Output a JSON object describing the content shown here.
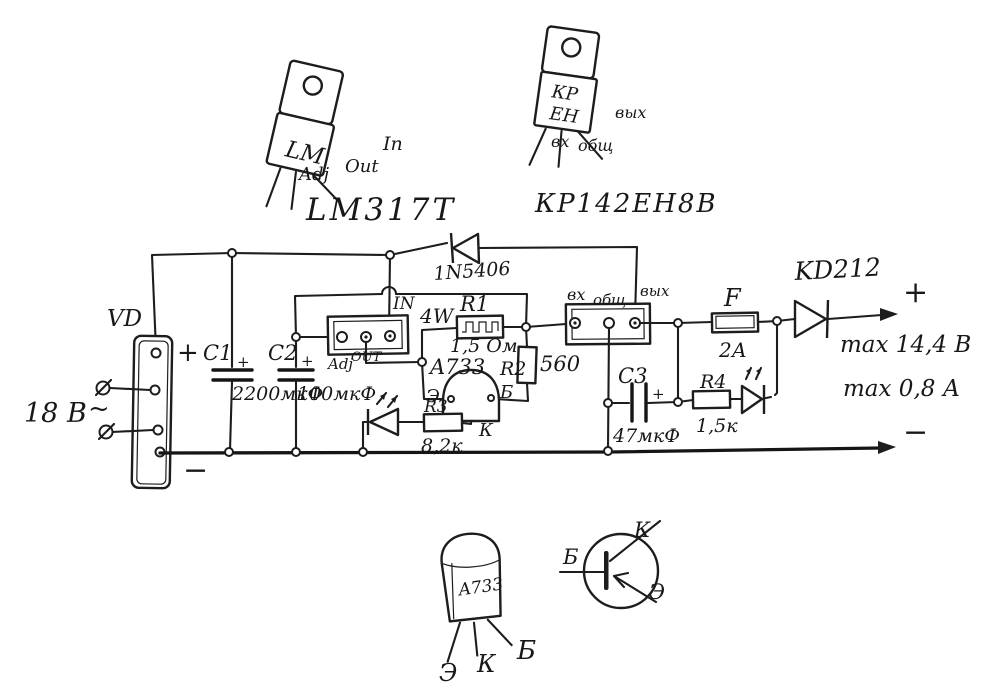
{
  "page": {
    "background": "#ffffff",
    "ink": "#1b1b1b"
  },
  "packages": {
    "lm317": {
      "title": "LM317T",
      "body": "LM",
      "pin_adj": "Adj",
      "pin_out": "Out",
      "pin_in": "In"
    },
    "kren": {
      "title": "КР142ЕН8В",
      "body_top": "КР",
      "body_bottom": "ЕН",
      "pin_in": "вх",
      "pin_gnd": "общ",
      "pin_out": "вых"
    }
  },
  "schematic": {
    "bridge": {
      "label": "VD",
      "plus": "+",
      "minus": "−",
      "input_voltage": "18 В",
      "ac_symbol": "~"
    },
    "protection_diode": {
      "label": "1N5406"
    },
    "regulator1": {
      "pin_in": "IN",
      "pin_adj": "Adj",
      "pin_out": "OUT"
    },
    "r1": {
      "label": "R1",
      "power": "4W",
      "value": "1,5 Ом"
    },
    "r2": {
      "label": "R2",
      "value": "560"
    },
    "r3": {
      "label": "R3",
      "value": "8,2к"
    },
    "r4": {
      "label": "R4",
      "value": "1,5к"
    },
    "c1": {
      "label": "C1",
      "value": "2200мкФ",
      "polarity": "+"
    },
    "c2": {
      "label": "C2",
      "value": "100мкФ",
      "polarity": "+"
    },
    "c3": {
      "label": "C3",
      "value": "47мкФ",
      "polarity": "+"
    },
    "q1": {
      "label": "A733",
      "emitter": "Э",
      "base": "Б",
      "collector": "К"
    },
    "regulator2": {
      "pin_in": "вх",
      "pin_gnd": "общ",
      "pin_out": "вых"
    },
    "fuse": {
      "label": "F",
      "value": "2А"
    },
    "output_diode": {
      "label": "KD212"
    },
    "output": {
      "plus": "+",
      "minus": "−",
      "max_voltage": "max 14,4 В",
      "max_current": "max 0,8 А"
    }
  },
  "bottom": {
    "package": {
      "title": "A733",
      "pin_e": "Э",
      "pin_k": "К",
      "pin_b": "Б"
    },
    "symbol": {
      "base": "Б",
      "collector": "К",
      "emitter": "Э"
    }
  }
}
